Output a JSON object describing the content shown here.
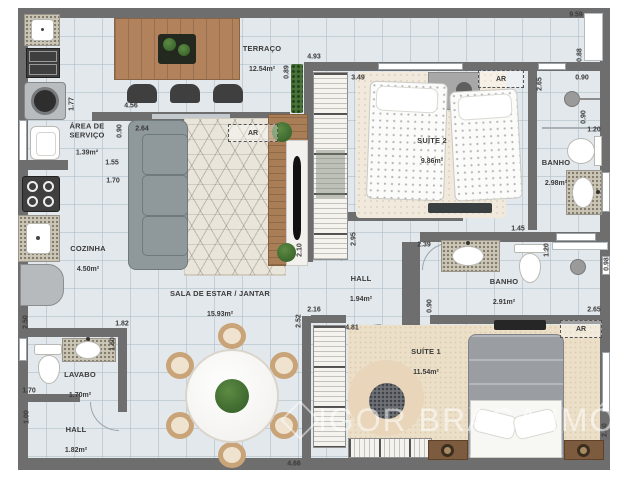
{
  "watermark": "IGOR BRAGA IMÓVEIS",
  "rooms": [
    {
      "name": "TERRAÇO",
      "area": "12.54m²"
    },
    {
      "name": "ÁREA DE SERVIÇO",
      "area": "1.39m²"
    },
    {
      "name": "COZINHA",
      "area": "4.50m²"
    },
    {
      "name": "SALA DE ESTAR / JANTAR",
      "area": "15.93m²"
    },
    {
      "name": "LAVABO",
      "area": "1.70m²"
    },
    {
      "name": "HALL",
      "area": "1.82m²"
    },
    {
      "name": "SUÍTE 2",
      "area": "9.86m²"
    },
    {
      "name": "BANHO",
      "area": "2.98m²"
    },
    {
      "name": "HALL",
      "area": "1.94m²"
    },
    {
      "name": "BANHO",
      "area": "2.91m²"
    },
    {
      "name": "SUÍTE 1",
      "area": "11.54m²"
    }
  ],
  "ac_labels": [
    "AR",
    "AR",
    "AR"
  ],
  "dims": [
    "1.77",
    "4.56",
    "0.90",
    "2.64",
    "1.55",
    "1.70",
    "0.89",
    "4.93",
    "3.49",
    "9.59",
    "0.88",
    "2.65",
    "0.90",
    "0.90",
    "1.20",
    "1.45",
    "2.50",
    "1.82",
    "1.60",
    "1.70",
    "1.00",
    "2.10",
    "2.95",
    "2.52",
    "2.16",
    "4.81",
    "2.39",
    "0.90",
    "1.20",
    "0.98",
    "2.65",
    "2.40",
    "4.66"
  ]
}
